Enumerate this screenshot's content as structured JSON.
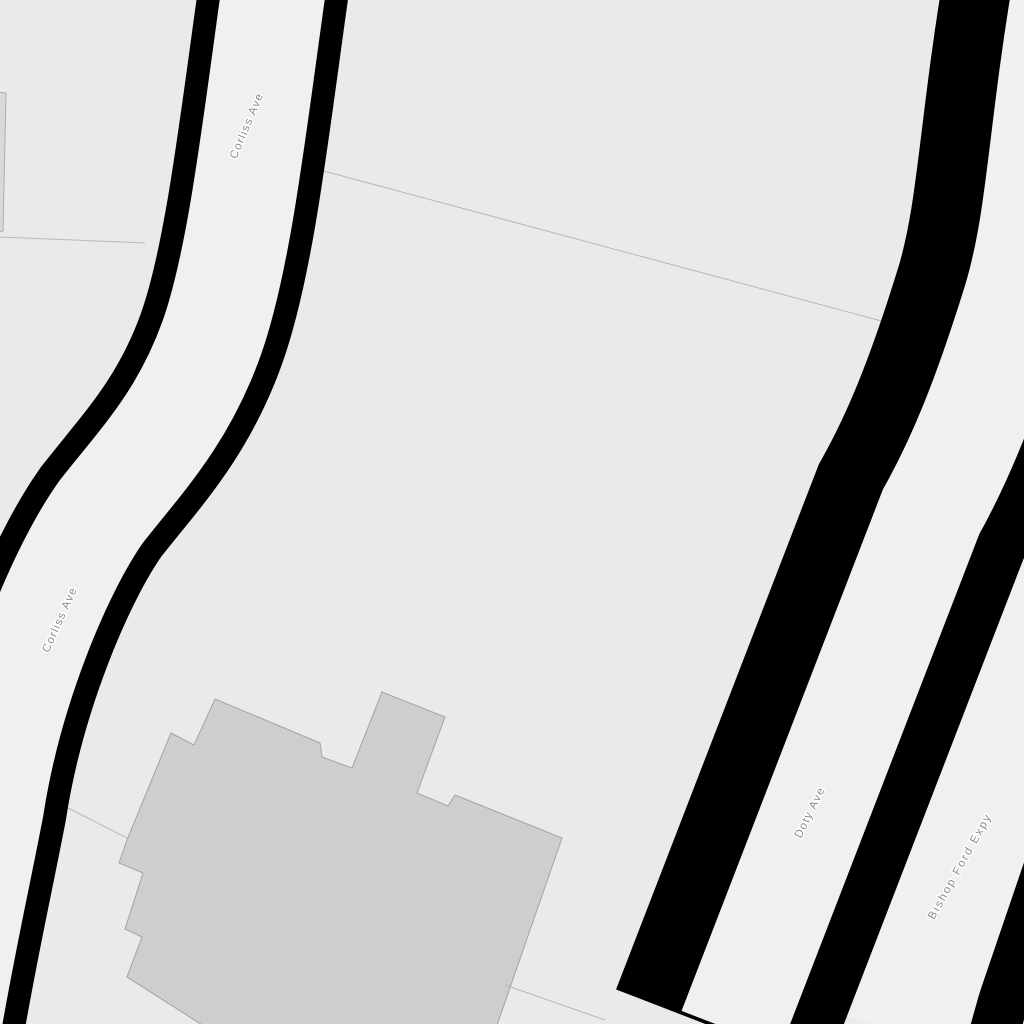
{
  "map": {
    "width": 1024,
    "height": 1024,
    "colors": {
      "background": "#eaeaea",
      "road_fill": "#f0f0f0",
      "casing": "#000000",
      "building_fill": "#cecece",
      "building_stroke": "#a3a3a3",
      "edge_building_fill": "#d9d9d9",
      "edge_building_stroke": "#aeaeae",
      "parcel_line": "#b9b9b9",
      "label_text": "#8d8d8d",
      "label_halo": "#ffffff"
    },
    "labels": [
      {
        "id": "road-label-corliss-ave-north",
        "text": "Corliss Ave",
        "x": 250,
        "y": 127,
        "rotate": -67,
        "letter_spacing": 1.2
      },
      {
        "id": "road-label-corliss-ave-south",
        "text": "Corliss Ave",
        "x": 63,
        "y": 621,
        "rotate": -66,
        "letter_spacing": 1.2
      },
      {
        "id": "road-label-doty-ave",
        "text": "Doty Ave",
        "x": 813,
        "y": 814,
        "rotate": -64,
        "letter_spacing": 1.2
      },
      {
        "id": "road-label-bishop-ford-expy",
        "text": "Bishop Ford Expy",
        "x": 963,
        "y": 868,
        "rotate": -61,
        "letter_spacing": 1.8
      }
    ],
    "parcel_lines": [
      {
        "id": "parcel-line-north",
        "x1": 320,
        "y1": 170,
        "x2": 889,
        "y2": 323
      },
      {
        "id": "parcel-line-west",
        "x1": 0,
        "y1": 237,
        "x2": 145,
        "y2": 243
      },
      {
        "id": "parcel-line-southwest",
        "x1": 68,
        "y1": 808,
        "x2": 129,
        "y2": 839
      }
    ],
    "parcel_lines_over": [
      {
        "id": "parcel-line-southeast",
        "x1": 505,
        "y1": 985,
        "x2": 605,
        "y2": 1020
      }
    ],
    "roads": [
      {
        "id": "bishop-ford-expy-right-casing",
        "kind": "casing",
        "path": "M1065,780 L994,1034",
        "width": 50
      },
      {
        "id": "bishop-ford-expy-surface",
        "kind": "road",
        "path": "M1123,380 L900,1034",
        "width": 124
      },
      {
        "id": "doty-ave-casing",
        "kind": "casing",
        "path": "M1055,-10 C1030,140 1030,220 1006,300 C975,400 950,460 921,512 L721,1030",
        "width": 225
      },
      {
        "id": "doty-ave-surface",
        "kind": "road",
        "path": "M1065,-10 C1040,140 1040,220 1016,300 C985,400 960,460 931,512 L731,1030",
        "width": 106
      },
      {
        "id": "corliss-ave-casing",
        "kind": "casing",
        "path": "M275,-20 C255,120 240,260 211,340 C182,420 140,462 101,512 C60,570 10,690 -8,807 C-22,880 -38,950 -52,1034",
        "width": 150
      },
      {
        "id": "corliss-ave-surface",
        "kind": "road",
        "path": "M275,-20 C255,120 240,260 211,340 C182,420 140,462 101,512 C60,570 10,690 -8,807 C-22,880 -38,950 -52,1034",
        "width": 104
      }
    ],
    "buildings": [
      {
        "id": "edge-building-west",
        "path": "M-3,92 L6,93 L3,231 L-3,232 Z",
        "kind": "edge"
      },
      {
        "id": "building-large-footprint",
        "kind": "main",
        "path": "M171,733 L194,745 L215,699 L320,743 L322,757 L352,768 L382,692 L445,717 L417,793 L448,806 L455,795 L562,838 L496,1028 L207,1028 L127,977 L142,937 L125,929 L143,873 L119,863 L127,840 Z"
      }
    ]
  }
}
